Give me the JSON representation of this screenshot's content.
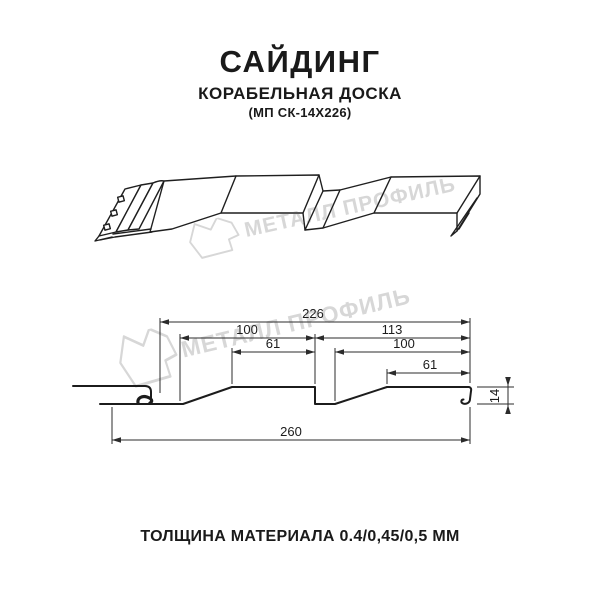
{
  "title": {
    "main": "САЙДИНГ",
    "subtitle": "КОРАБЕЛЬНАЯ ДОСКА",
    "model": "(МП СК-14Х226)"
  },
  "watermark": {
    "text": "МЕТАЛЛ ПРОФИЛЬ",
    "logo": "metall-profil-logo",
    "color": "#d7d7d7"
  },
  "drawing": {
    "kind": "technical drawing of ship-lap metal siding panel",
    "views": [
      "3d-perspective-view",
      "cross-section-with-dimensions"
    ]
  },
  "section": {
    "dims": {
      "d226": "226",
      "d100_left": "100",
      "d61_left": "61",
      "d113": "113",
      "d100_right": "100",
      "d61_right": "61",
      "d260": "260",
      "d14": "14"
    },
    "dimensions_mm": {
      "module_width": 226,
      "total_width": 260,
      "profile_height": 14,
      "left_board": {
        "pitch": 100,
        "flat_top": 61
      },
      "right_board": {
        "span": 113,
        "pitch": 100,
        "flat_top": 61
      }
    }
  },
  "footer": {
    "thickness": "ТОЛЩИНА МАТЕРИАЛА 0.4/0,45/0,5 ММ"
  },
  "colors": {
    "line": "#1f1f1f",
    "dimension": "#2b2b2b",
    "text": "#1a1a1a",
    "watermark": "#d7d7d7"
  }
}
